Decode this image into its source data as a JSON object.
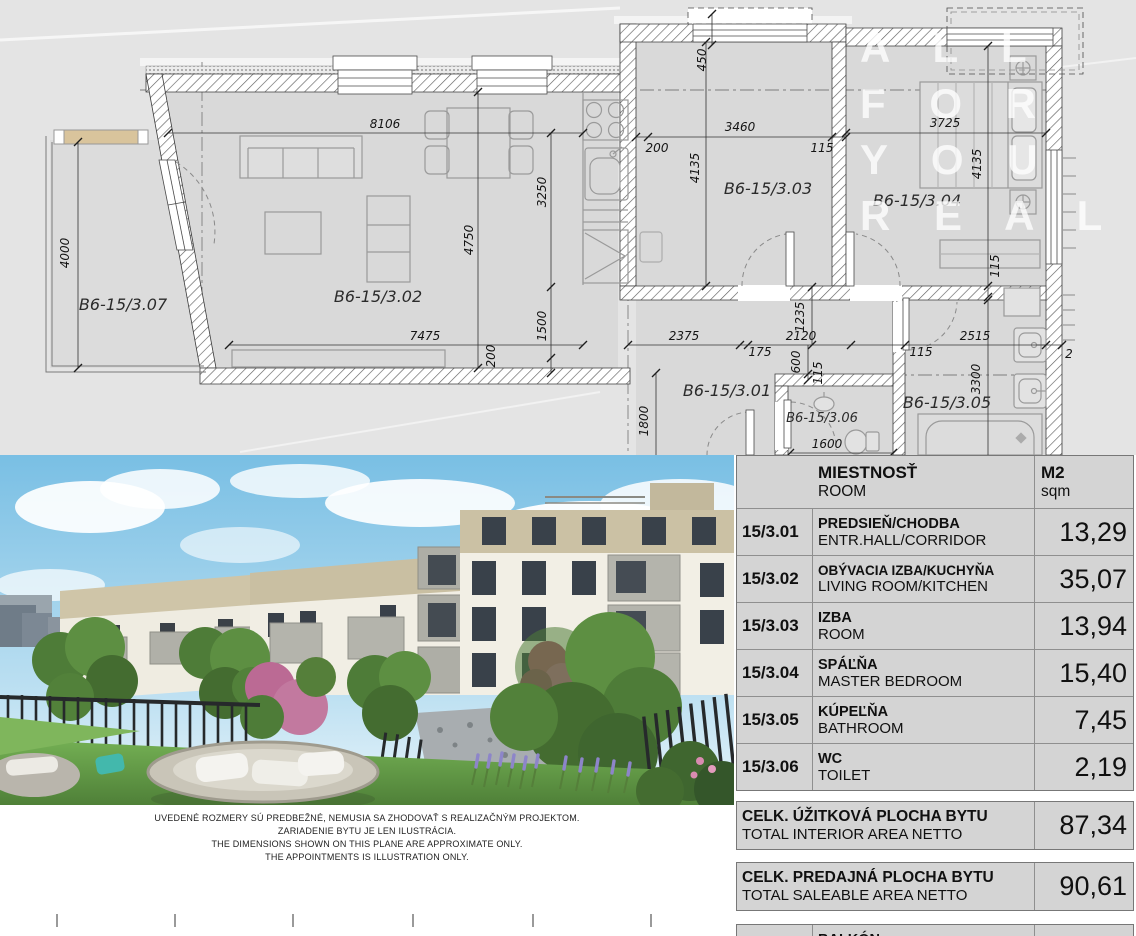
{
  "plan": {
    "watermark": [
      "A L L",
      "F O R",
      "Y O U",
      "R E A L"
    ],
    "rooms": [
      "B6-15/3.07",
      "B6-15/3.02",
      "B6-15/3.03",
      "B6-15/3.04",
      "B6-15/3.01",
      "B6-15/3.06",
      "B6-15/3.05"
    ],
    "dims": [
      "8106",
      "4750",
      "3250",
      "1500",
      "200",
      "7475",
      "4000",
      "450",
      "200",
      "3460",
      "115",
      "4135",
      "3725",
      "4135",
      "115",
      "2375",
      "175",
      "2120",
      "115",
      "2515",
      "1235",
      "600",
      "115",
      "1800",
      "1600",
      "3300",
      "2"
    ]
  },
  "photo": {
    "caption": [
      "UVEDENÉ ROZMERY SÚ PREDBEŽNÉ, NEMUSIA SA ZHODOVAŤ S REALIZAČNÝM PROJEKTOM.",
      "ZARIADENIE BYTU JE LEN ILUSTRÁCIA.",
      "THE DIMENSIONS SHOWN ON THIS PLANE ARE APPROXIMATE ONLY.",
      "THE APPOINTMENTS IS ILLUSTRATION ONLY."
    ]
  },
  "table": {
    "header": {
      "name_sk": "MIESTNOSŤ",
      "name_en": "ROOM",
      "area_sk": "M2",
      "area_en": "sqm"
    },
    "rows": [
      {
        "code": "15/3.01",
        "name_sk": "PREDSIEŇ/CHODBA",
        "name_en": "ENTR.HALL/CORRIDOR",
        "area": "13,29"
      },
      {
        "code": "15/3.02",
        "name_sk": "OBÝVACIA IZBA/KUCHYŇA",
        "name_en": "LIVING ROOM/KITCHEN",
        "area": "35,07"
      },
      {
        "code": "15/3.03",
        "name_sk": "IZBA",
        "name_en": "ROOM",
        "area": "13,94"
      },
      {
        "code": "15/3.04",
        "name_sk": "SPÁĽŇA",
        "name_en": "MASTER BEDROOM",
        "area": "15,40"
      },
      {
        "code": "15/3.05",
        "name_sk": "KÚPEĽŇA",
        "name_en": "BATHROOM",
        "area": "7,45"
      },
      {
        "code": "15/3.06",
        "name_sk": "WC",
        "name_en": "TOILET",
        "area": "2,19"
      }
    ],
    "summary": [
      {
        "name_sk": "CELK. ÚŽITKOVÁ PLOCHA BYTU",
        "name_en": "TOTAL INTERIOR AREA NETTO",
        "area": "87,34"
      },
      {
        "name_sk": "CELK. PREDAJNÁ PLOCHA BYTU",
        "name_en": "TOTAL SALEABLE AREA NETTO",
        "area": "90,61"
      }
    ],
    "extra_row": {
      "code": "15/3.07",
      "name_sk": "BALKÓN",
      "name_en": "BALCONY",
      "area": "7,79"
    }
  }
}
